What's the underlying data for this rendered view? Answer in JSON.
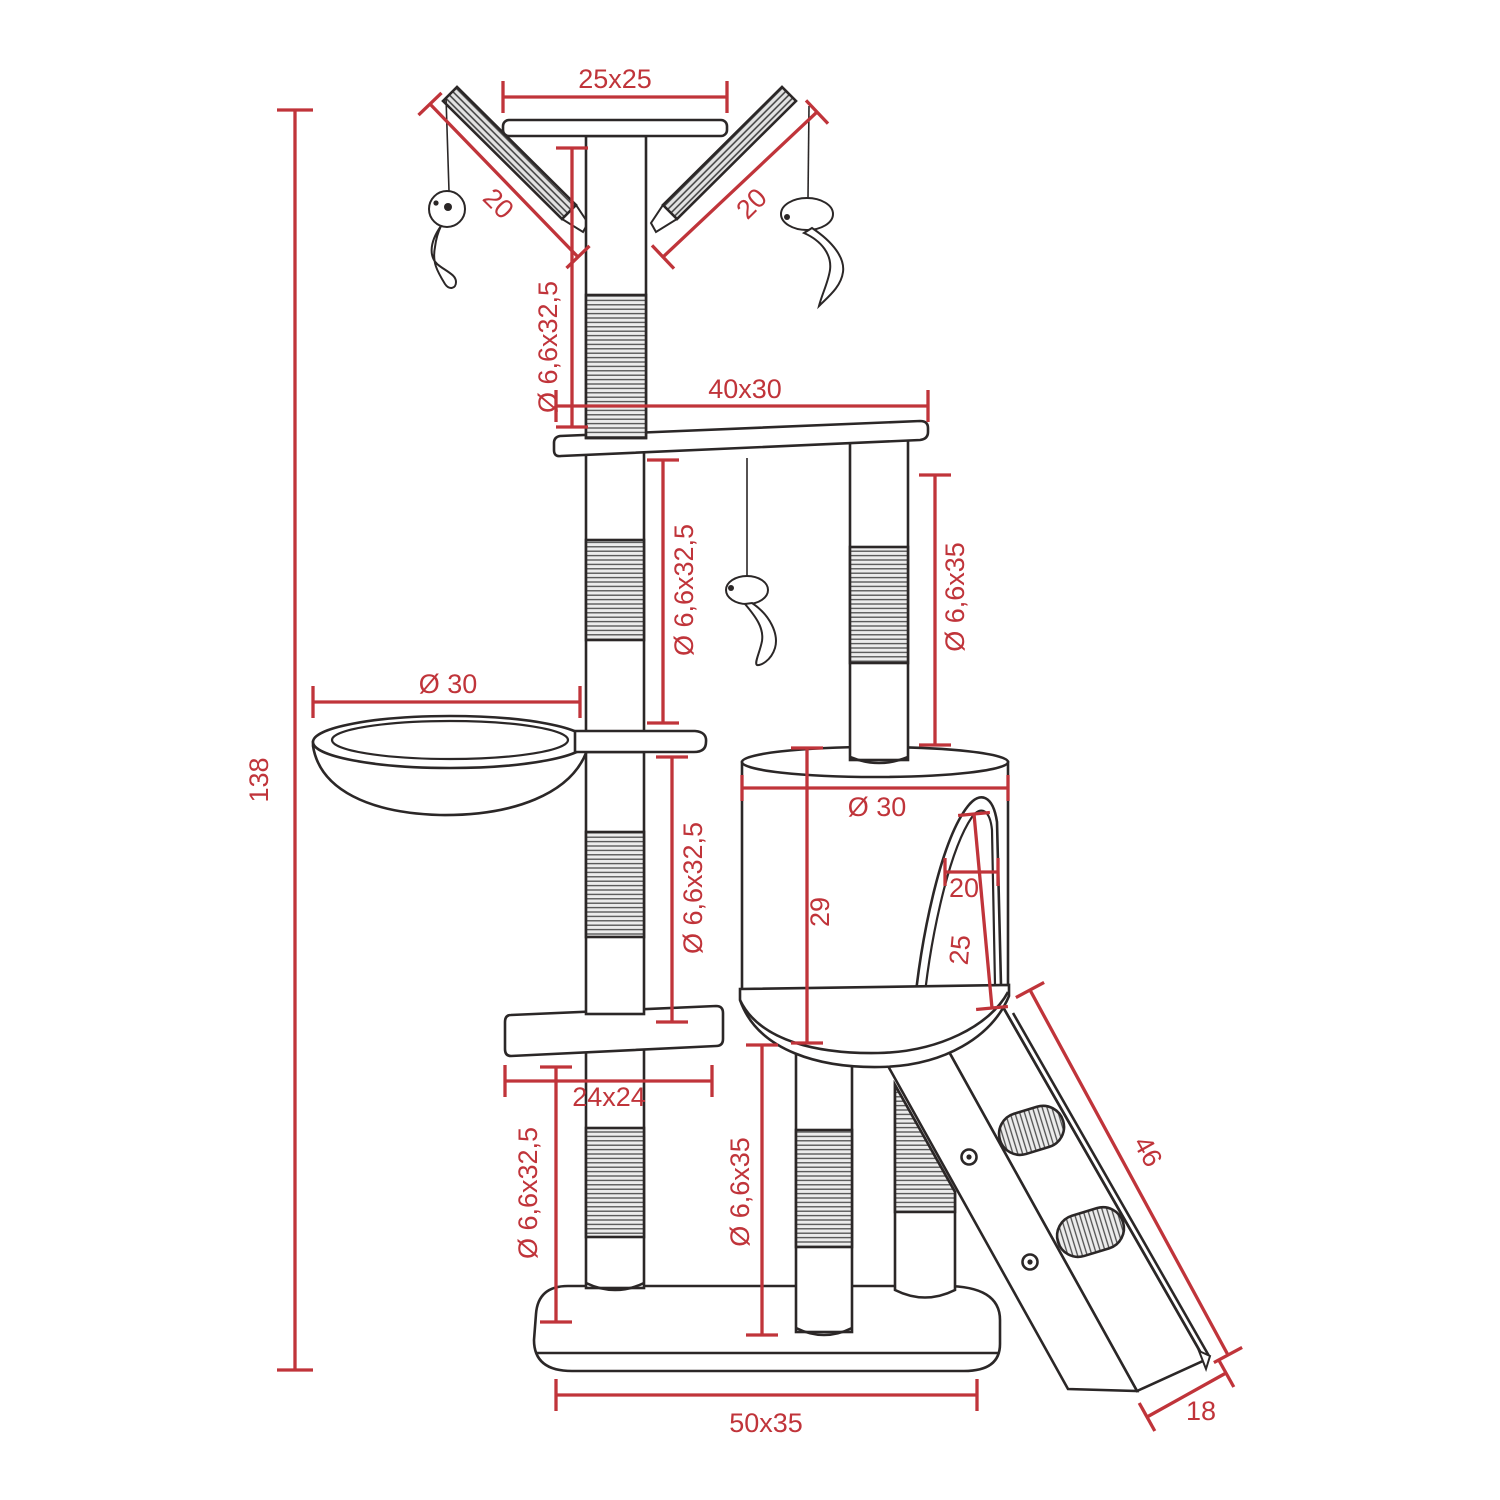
{
  "title": "Cat scratching tree technical drawing",
  "colors": {
    "dimension": "#c0343a",
    "outline": "#2b2727",
    "background": "#ffffff",
    "sisal_fill": "#ececec"
  },
  "dimensions": {
    "overall_height": "138",
    "top_platform": "25x25",
    "left_scratch_ramp": "20",
    "right_scratch_ramp": "20",
    "top_post": "Ø 6,6x32,5",
    "middle_platform": "40x30",
    "upper_left_post": "Ø 6,6x32,5",
    "upper_right_post": "Ø 6,6x35",
    "basket_diameter": "Ø 30",
    "middle_post": "Ø 6,6x32,5",
    "barrel_diameter": "Ø 30",
    "barrel_height": "29",
    "barrel_opening_width": "20",
    "barrel_opening_height": "25",
    "small_platform": "24x24",
    "bottom_left_post": "Ø 6,6x32,5",
    "bottom_middle_post": "Ø 6,6x35",
    "ladder_length": "46",
    "ladder_width": "18",
    "base_plate": "50x35"
  }
}
